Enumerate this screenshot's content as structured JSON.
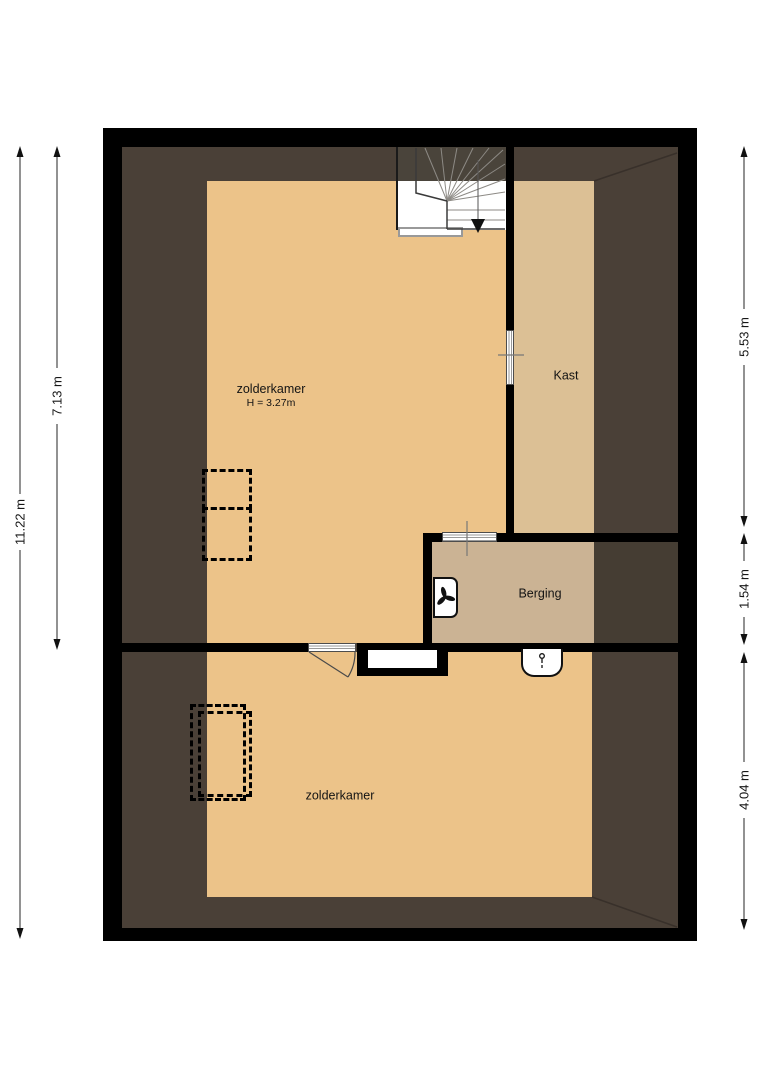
{
  "plan_type": "attic-floorplan",
  "rooms": {
    "zolderkamer_upper": {
      "label": "zolderkamer",
      "height_label": "H = 3.27m"
    },
    "kast": {
      "label": "Kast"
    },
    "berging": {
      "label": "Berging"
    },
    "zolderkamer_lower": {
      "label": "zolderkamer"
    }
  },
  "dimensions": {
    "total_height_left": "11.22 m",
    "upper_section_left": "7.13 m",
    "top_section_right": "5.53 m",
    "middle_section_right": "1.54 m",
    "bottom_section_right": "4.04 m"
  },
  "symbols": {
    "stairs": "winder-staircase-with-down-arrow",
    "ventilation_unit": "mechanical-ventilation-fan-icon",
    "sink": "small-washbasin-with-tap-icon",
    "wardrobes": "dashed-wardrobe-outline",
    "doors": "striped-door-leaf"
  },
  "colors": {
    "page_background": "#ffffff",
    "wall": "#000000",
    "under_eaves": "#4a4037",
    "under_eaves_dark": "#453d33",
    "floor_main": "#ecc389",
    "floor_kast": "#dcc095",
    "floor_berging": "#cbb394",
    "stair_shade": "#4a443b"
  }
}
